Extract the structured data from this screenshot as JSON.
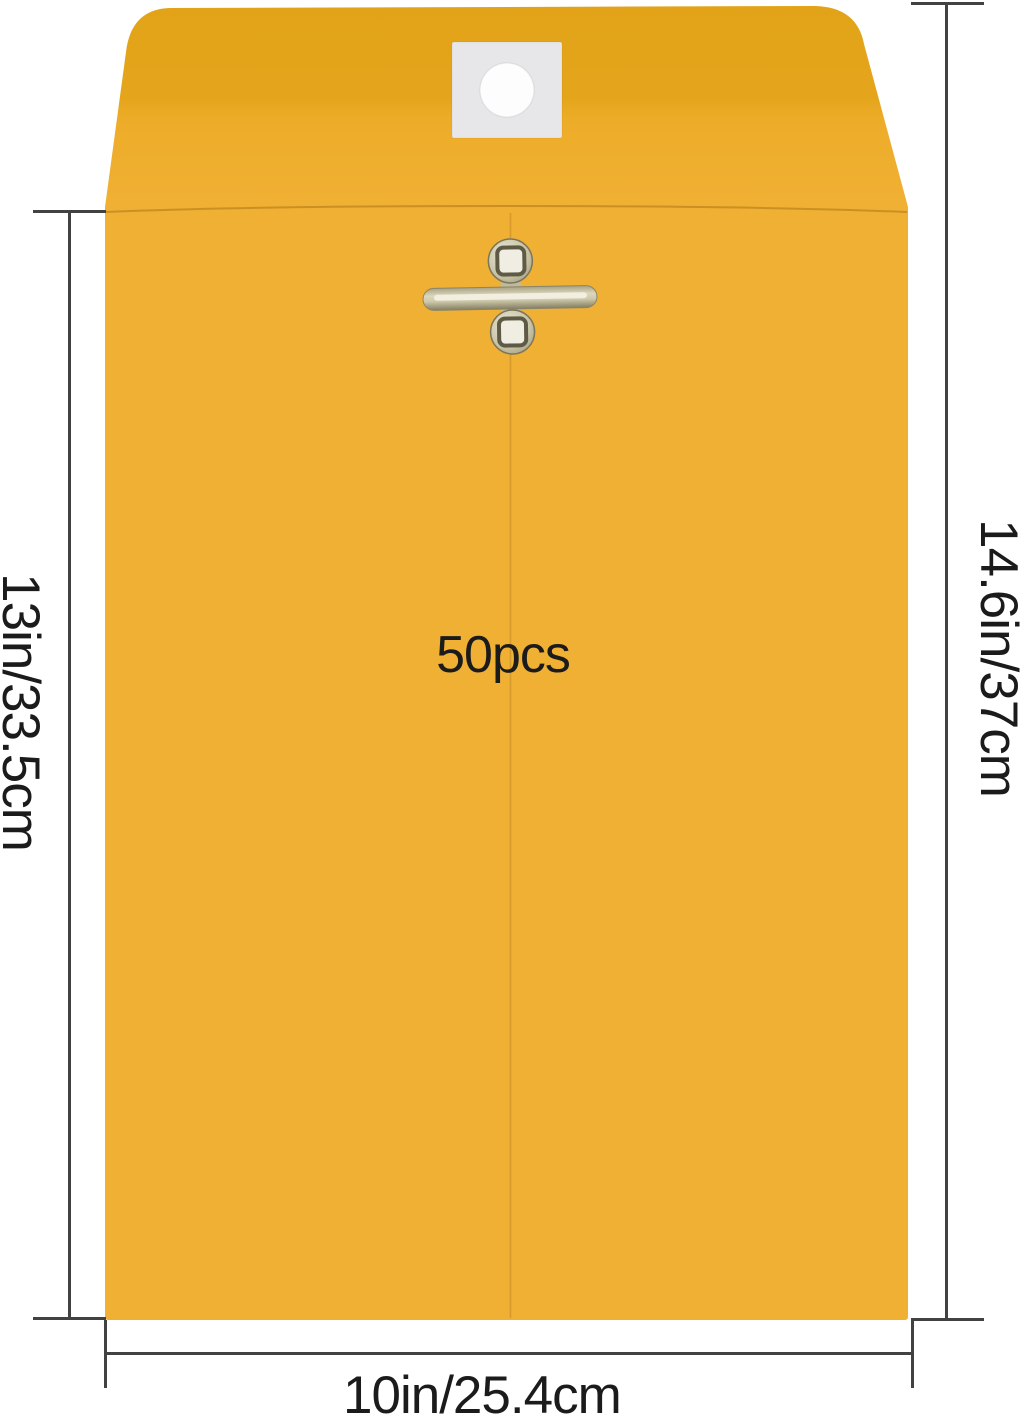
{
  "envelope": {
    "count_label": "50pcs"
  },
  "annotations": {
    "body_height": "13in/33.5cm",
    "total_height": "14.6in/37cm",
    "width": "10in/25.4cm"
  },
  "colors": {
    "background": "#ffffff",
    "envelope_body": "#f0b034",
    "envelope_flap": "#e4a51c",
    "patch": "#e7e6e8",
    "hole": "#fdfdfe",
    "clasp_metal_light": "#ece9d8",
    "clasp_metal_mid": "#c9c4a6",
    "clasp_metal_dark": "#837d62",
    "dimension_line": "#424242",
    "label_text": "#1b1b1b"
  }
}
